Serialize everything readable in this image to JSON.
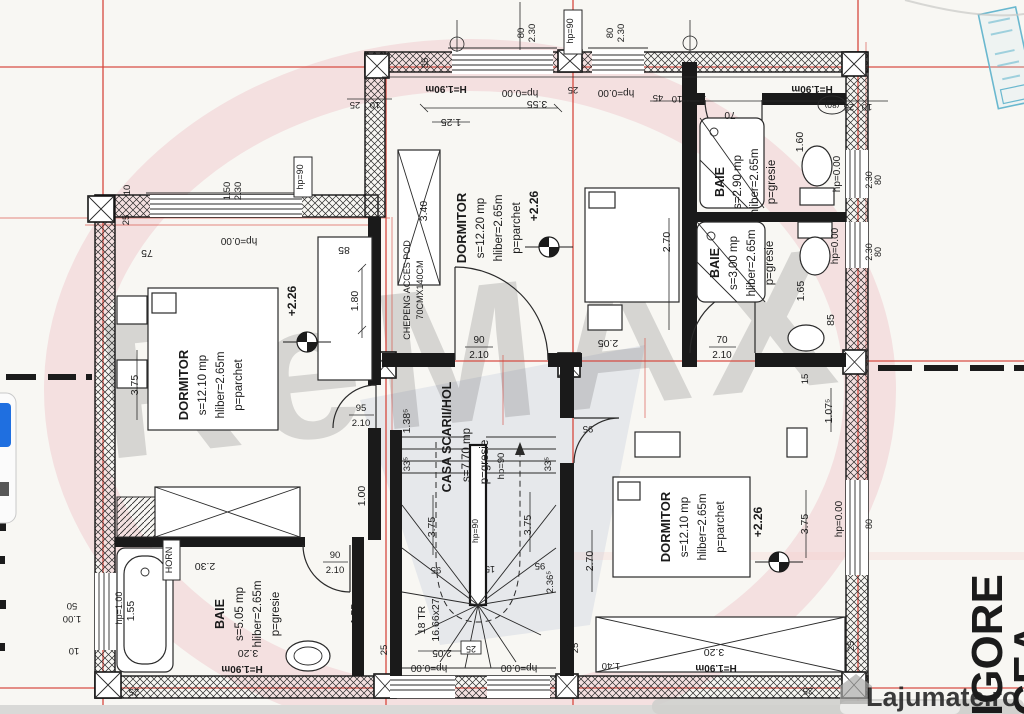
{
  "watermark": {
    "brand": "ReMAX",
    "site_name": "Lajumate",
    "site_tld": ".ro"
  },
  "margin_text": {
    "street_line1": "IGORE",
    "street_line2": "CEA"
  },
  "rooms": {
    "dormitor_left": {
      "name": "DORMITOR",
      "area": "s=12.10 mp",
      "height": "hliber=2.65m",
      "floor": "p=parchet",
      "level": "+2.26"
    },
    "dormitor_top": {
      "name": "DORMITOR",
      "area": "s=12.20 mp",
      "height": "hliber=2.65m",
      "floor": "p=parchet",
      "level": "+2.26"
    },
    "dormitor_right": {
      "name": "DORMITOR",
      "area": "s=12.10 mp",
      "height": "hliber=2.65m",
      "floor": "p=parchet",
      "level": "+2.26"
    },
    "baie_top": {
      "name": "BAIE",
      "area": "s=2.90 mp",
      "height": "hliber=2.65m",
      "floor": "p=gresie"
    },
    "baie_mid": {
      "name": "BAIE",
      "area": "s=3.00 mp",
      "height": "hliber=2.65m",
      "floor": "p=gresie"
    },
    "baie_bottom": {
      "name": "BAIE",
      "area": "s=5.05 mp",
      "height": "hliber=2.65m",
      "floor": "p=gresie"
    },
    "hall": {
      "name": "CASA SCARII/HOL",
      "area": "s=7.70 mp",
      "floor": "p=gresie"
    }
  },
  "stairs": {
    "count": "18 TR",
    "tread": "16.66x27"
  },
  "annotations": {
    "chepeng1": "CHEPENG ACCES POD",
    "chepeng2": "70CMX140CM",
    "horn": "HORN",
    "h_190": "H=1.90m",
    "hp_000": "hp=0.00",
    "hp_90": "hp=90",
    "hp_100": "hp=1.00"
  },
  "dims": {
    "d10": "10",
    "d15": "15",
    "d25": "25",
    "d35": "35",
    "d45": "45",
    "d50": "50",
    "d70": "70",
    "d75": "75",
    "d80": "80",
    "d80p": "(80)",
    "d85": "85",
    "d90": "90",
    "d95": "95",
    "d100": "1.00",
    "d1075": "1.07⁵",
    "d125": "1.25",
    "d1385": "1.38⁵",
    "d140": "1.40",
    "d150": "1.50",
    "d155": "1.55",
    "d160": "1.60",
    "d165": "1.65",
    "d180": "1.80",
    "d205": "2.05",
    "d210": "2.10",
    "d230": "2.30",
    "d2365": "2.36⁵",
    "d270": "2.70",
    "d320": "3.20",
    "d335": "33⁵",
    "d340": "3.40",
    "d355": "3.55",
    "d375": "3.75"
  },
  "colors": {
    "grid_red": "#d6463c",
    "stamp_blue": "#6ab8cf",
    "site_teal": "#2fb5a8",
    "button_blue": "#1f6fe0"
  }
}
